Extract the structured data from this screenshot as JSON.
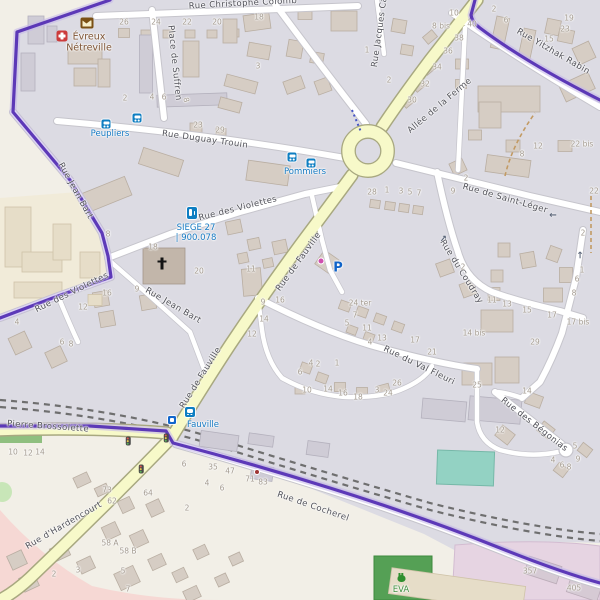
{
  "place": {
    "line1": "Évreux",
    "line2": "Nétreville"
  },
  "colors": {
    "boundary": "#5530b4",
    "road_secondary": "#f7f9c9",
    "transit_blue": "#1579c2",
    "residential": "#dcdbe3",
    "building": "#d6cdc4",
    "leisure_green": "#55a055",
    "pitch_teal": "#93d2c3",
    "retail_pink": "#f6d8d4",
    "commercial_lavender": "#e6d4e2"
  },
  "streets": [
    {
      "t": "Rue Christophe Colomb",
      "x": 243,
      "y": 4,
      "r": -3
    },
    {
      "t": "Place de Suffren",
      "x": 174,
      "y": 63,
      "r": 84
    },
    {
      "t": "Rue Duguay Trouin",
      "x": 205,
      "y": 140,
      "r": 8
    },
    {
      "t": "Rue des Violettes",
      "x": 238,
      "y": 209,
      "r": -14
    },
    {
      "t": "Rue de Fauville",
      "x": 299,
      "y": 262,
      "r": -54
    },
    {
      "t": "Rue de Fauville",
      "x": 201,
      "y": 378,
      "r": -58
    },
    {
      "t": "Rue Jean Bart",
      "x": 75,
      "y": 191,
      "r": 61
    },
    {
      "t": "Rue Jean Bart",
      "x": 173,
      "y": 306,
      "r": 30
    },
    {
      "t": "Rue des Violettes",
      "x": 72,
      "y": 293,
      "r": -26
    },
    {
      "t": "Allée de la Ferme",
      "x": 440,
      "y": 106,
      "r": -40
    },
    {
      "t": "Rue de Saint-Léger",
      "x": 505,
      "y": 199,
      "r": 16
    },
    {
      "t": "Rue Yitzhak Rabin",
      "x": 553,
      "y": 52,
      "r": 30
    },
    {
      "t": "Rue Jacques Ca",
      "x": 380,
      "y": 32,
      "r": -82
    },
    {
      "t": "Rue du Coudray",
      "x": 461,
      "y": 272,
      "r": 58
    },
    {
      "t": "Rue du Val Fleuri",
      "x": 419,
      "y": 366,
      "r": 26
    },
    {
      "t": "Rue des Bégonias",
      "x": 534,
      "y": 425,
      "r": 38
    },
    {
      "t": "Pierre Brossolette",
      "x": 48,
      "y": 427,
      "r": 4
    },
    {
      "t": "Rue d'Hardencourt",
      "x": 64,
      "y": 526,
      "r": -30
    },
    {
      "t": "Rue de Cocherel",
      "x": 313,
      "y": 507,
      "r": 19
    }
  ],
  "transit_labels": [
    {
      "t": "Peupliers",
      "x": 110,
      "y": 134
    },
    {
      "t": "Pommiers",
      "x": 305,
      "y": 172
    },
    {
      "t": "SIEGE 27",
      "x": 196,
      "y": 228
    },
    {
      "t": "| 900.078",
      "x": 196,
      "y": 238
    },
    {
      "t": "Fauville",
      "x": 203,
      "y": 425
    }
  ],
  "poi_labels": [
    {
      "t": "P",
      "x": 338,
      "y": 268,
      "n": "parking-symbol"
    },
    {
      "t": "EVA",
      "x": 401,
      "y": 590,
      "n": "leisure-label"
    }
  ],
  "house_numbers": [
    {
      "t": "26",
      "x": 124,
      "y": 22
    },
    {
      "t": "24",
      "x": 156,
      "y": 22
    },
    {
      "t": "22",
      "x": 187,
      "y": 22
    },
    {
      "t": "20",
      "x": 217,
      "y": 22
    },
    {
      "t": "18",
      "x": 259,
      "y": 17
    },
    {
      "t": "3",
      "x": 258,
      "y": 66
    },
    {
      "t": "2",
      "x": 125,
      "y": 98
    },
    {
      "t": "4",
      "x": 152,
      "y": 97
    },
    {
      "t": "6",
      "x": 164,
      "y": 97
    },
    {
      "t": "8",
      "x": 186,
      "y": 100,
      "r": 75
    },
    {
      "t": "1",
      "x": 367,
      "y": 50
    },
    {
      "t": "2",
      "x": 389,
      "y": 80
    },
    {
      "t": "10",
      "x": 454,
      "y": 13
    },
    {
      "t": "8 bis",
      "x": 441,
      "y": 26
    },
    {
      "t": "40",
      "x": 472,
      "y": 24
    },
    {
      "t": "38",
      "x": 459,
      "y": 38
    },
    {
      "t": "36",
      "x": 448,
      "y": 51
    },
    {
      "t": "34",
      "x": 437,
      "y": 67
    },
    {
      "t": "32",
      "x": 425,
      "y": 84
    },
    {
      "t": "30",
      "x": 412,
      "y": 100
    },
    {
      "t": "2",
      "x": 494,
      "y": 9
    },
    {
      "t": "6",
      "x": 506,
      "y": 20
    },
    {
      "t": "19",
      "x": 569,
      "y": 18
    },
    {
      "t": "23",
      "x": 565,
      "y": 29
    },
    {
      "t": "15",
      "x": 549,
      "y": 39
    },
    {
      "t": "23",
      "x": 198,
      "y": 125
    },
    {
      "t": "29",
      "x": 220,
      "y": 130
    },
    {
      "t": "12",
      "x": 538,
      "y": 146
    },
    {
      "t": "8",
      "x": 522,
      "y": 154
    },
    {
      "t": "22 bis",
      "x": 582,
      "y": 144
    },
    {
      "t": "22",
      "x": 594,
      "y": 191
    },
    {
      "t": "2",
      "x": 466,
      "y": 178
    },
    {
      "t": "9",
      "x": 453,
      "y": 191
    },
    {
      "t": "28",
      "x": 372,
      "y": 192
    },
    {
      "t": "1",
      "x": 387,
      "y": 190
    },
    {
      "t": "3",
      "x": 401,
      "y": 191
    },
    {
      "t": "5",
      "x": 410,
      "y": 192
    },
    {
      "t": "7",
      "x": 419,
      "y": 193
    },
    {
      "t": "2",
      "x": 583,
      "y": 233
    },
    {
      "t": "8",
      "x": 108,
      "y": 234
    },
    {
      "t": "18",
      "x": 153,
      "y": 247
    },
    {
      "t": "20",
      "x": 199,
      "y": 271
    },
    {
      "t": "11",
      "x": 251,
      "y": 269
    },
    {
      "t": "16",
      "x": 107,
      "y": 293
    },
    {
      "t": "9",
      "x": 137,
      "y": 289
    },
    {
      "t": "12",
      "x": 83,
      "y": 307
    },
    {
      "t": "4",
      "x": 17,
      "y": 322
    },
    {
      "t": "6",
      "x": 62,
      "y": 342
    },
    {
      "t": "8",
      "x": 71,
      "y": 344
    },
    {
      "t": "9",
      "x": 263,
      "y": 302
    },
    {
      "t": "16",
      "x": 280,
      "y": 300
    },
    {
      "t": "14",
      "x": 264,
      "y": 319
    },
    {
      "t": "12",
      "x": 252,
      "y": 334
    },
    {
      "t": "24 ter",
      "x": 360,
      "y": 303
    },
    {
      "t": "7",
      "x": 355,
      "y": 315
    },
    {
      "t": "5",
      "x": 347,
      "y": 323
    },
    {
      "t": "11",
      "x": 367,
      "y": 328
    },
    {
      "t": "13",
      "x": 382,
      "y": 338
    },
    {
      "t": "4",
      "x": 370,
      "y": 342
    },
    {
      "t": "17",
      "x": 415,
      "y": 340
    },
    {
      "t": "21",
      "x": 432,
      "y": 352
    },
    {
      "t": "1",
      "x": 337,
      "y": 363
    },
    {
      "t": "2",
      "x": 318,
      "y": 364
    },
    {
      "t": "4",
      "x": 311,
      "y": 363
    },
    {
      "t": "6",
      "x": 300,
      "y": 372
    },
    {
      "t": "10",
      "x": 307,
      "y": 390
    },
    {
      "t": "14",
      "x": 328,
      "y": 389
    },
    {
      "t": "16",
      "x": 343,
      "y": 393
    },
    {
      "t": "18",
      "x": 358,
      "y": 397
    },
    {
      "t": "3",
      "x": 377,
      "y": 390
    },
    {
      "t": "24",
      "x": 388,
      "y": 393
    },
    {
      "t": "26",
      "x": 397,
      "y": 383
    },
    {
      "t": "25",
      "x": 477,
      "y": 385
    },
    {
      "t": "11",
      "x": 492,
      "y": 300
    },
    {
      "t": "13",
      "x": 507,
      "y": 304
    },
    {
      "t": "15",
      "x": 527,
      "y": 310
    },
    {
      "t": "17",
      "x": 552,
      "y": 315
    },
    {
      "t": "17 bis",
      "x": 578,
      "y": 322
    },
    {
      "t": "14 bis",
      "x": 474,
      "y": 333
    },
    {
      "t": "29",
      "x": 535,
      "y": 342
    },
    {
      "t": "2",
      "x": 463,
      "y": 267
    },
    {
      "t": "1",
      "x": 582,
      "y": 270
    },
    {
      "t": "6",
      "x": 577,
      "y": 279
    },
    {
      "t": "8",
      "x": 574,
      "y": 293
    },
    {
      "t": "14",
      "x": 527,
      "y": 391
    },
    {
      "t": "12",
      "x": 500,
      "y": 430
    },
    {
      "t": "5",
      "x": 575,
      "y": 446
    },
    {
      "t": "9",
      "x": 578,
      "y": 459
    },
    {
      "t": "4",
      "x": 553,
      "y": 460
    },
    {
      "t": "6",
      "x": 562,
      "y": 465
    },
    {
      "t": "8",
      "x": 569,
      "y": 467
    },
    {
      "t": "10",
      "x": 13,
      "y": 452
    },
    {
      "t": "12",
      "x": 28,
      "y": 453
    },
    {
      "t": "14",
      "x": 40,
      "y": 452
    },
    {
      "t": "6",
      "x": 184,
      "y": 464
    },
    {
      "t": "35",
      "x": 213,
      "y": 467
    },
    {
      "t": "47",
      "x": 230,
      "y": 471
    },
    {
      "t": "71",
      "x": 250,
      "y": 479
    },
    {
      "t": "83",
      "x": 263,
      "y": 482
    },
    {
      "t": "4",
      "x": 207,
      "y": 483
    },
    {
      "t": "6",
      "x": 222,
      "y": 488
    },
    {
      "t": "73",
      "x": 107,
      "y": 490
    },
    {
      "t": "62",
      "x": 112,
      "y": 501
    },
    {
      "t": "64",
      "x": 148,
      "y": 493
    },
    {
      "t": "2",
      "x": 187,
      "y": 508
    },
    {
      "t": "58 A",
      "x": 110,
      "y": 543
    },
    {
      "t": "58 B",
      "x": 128,
      "y": 551
    },
    {
      "t": "5",
      "x": 123,
      "y": 571
    },
    {
      "t": "2",
      "x": 54,
      "y": 574
    },
    {
      "t": "3",
      "x": 78,
      "y": 570
    },
    {
      "t": "7",
      "x": 128,
      "y": 589
    },
    {
      "t": "357",
      "x": 530,
      "y": 571
    },
    {
      "t": "405",
      "x": 574,
      "y": 588
    }
  ],
  "icons": [
    {
      "n": "pharmacy-icon",
      "x": 62,
      "y": 36
    },
    {
      "n": "post-office-icon",
      "x": 87,
      "y": 23
    },
    {
      "n": "bus-stop-icon",
      "x": 106,
      "y": 124
    },
    {
      "n": "bus-stop-icon",
      "x": 137,
      "y": 118
    },
    {
      "n": "bus-stop-icon",
      "x": 292,
      "y": 157
    },
    {
      "n": "bus-stop-icon",
      "x": 311,
      "y": 163
    },
    {
      "n": "charging-station-icon",
      "x": 192,
      "y": 213
    },
    {
      "n": "railway-station-icon",
      "x": 190,
      "y": 412
    },
    {
      "n": "station-entrance-icon",
      "x": 172,
      "y": 420
    },
    {
      "n": "traffic-signal-icon",
      "x": 128,
      "y": 441
    },
    {
      "n": "traffic-signal-icon",
      "x": 166,
      "y": 438
    },
    {
      "n": "traffic-signal-icon",
      "x": 141,
      "y": 469
    },
    {
      "n": "church-cross-icon",
      "x": 162,
      "y": 264
    },
    {
      "n": "bug-icon",
      "x": 401,
      "y": 577
    },
    {
      "n": "shop-icon-pink",
      "x": 321,
      "y": 261
    },
    {
      "n": "shop-icon-red",
      "x": 257,
      "y": 472
    },
    {
      "n": "oneway-arrow-icon",
      "t": "→",
      "x": 553,
      "y": 214,
      "r": 180
    },
    {
      "n": "oneway-arrow-icon",
      "t": "→",
      "x": 444,
      "y": 239,
      "r": -50
    },
    {
      "n": "oneway-arrow-icon",
      "t": "→",
      "x": 581,
      "y": 255,
      "r": -90
    }
  ]
}
